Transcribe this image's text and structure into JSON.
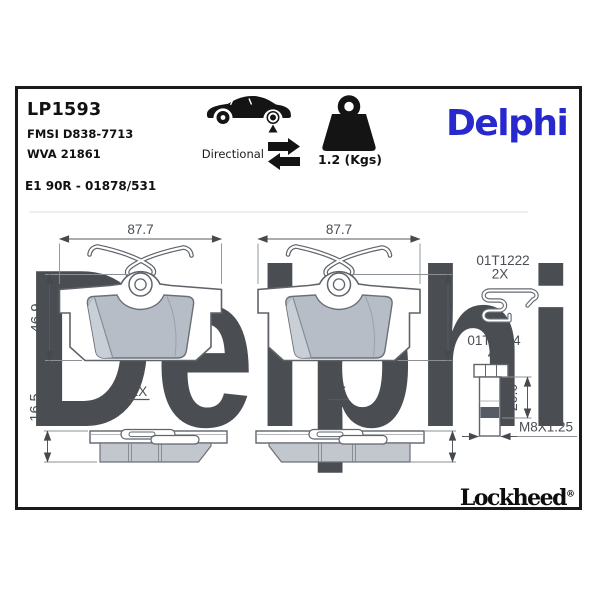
{
  "header": {
    "part_number": "LP1593",
    "fmsi_code": "FMSI D838-7713",
    "wva_code": "WVA 21861",
    "ece_approval": "E1 90R - 01878/531",
    "directional_label": "Directional",
    "weight_value": "1.2 (Kgs)"
  },
  "branding": {
    "logo_text": "Delphi",
    "watermark_text": "Delphi",
    "footer_logo_text": "Lockheed",
    "registered_symbol": "®"
  },
  "pad_set": {
    "width_mm": "87.7",
    "height_mm": "46.9",
    "thickness_mm": "16.5",
    "quantity_label": "2X"
  },
  "hardware": {
    "clip_part_number": "01T1222",
    "clip_quantity": "2X",
    "bolt_part_number": "01T0924",
    "bolt_quantity": "4X",
    "bolt_grip_length_mm": "20.0",
    "bolt_thread_spec": "M8X1.25"
  },
  "colors": {
    "brand_blue": "#2828cf",
    "watermark_blue": "#d2daea",
    "friction_gray": "#b7bdc6",
    "friction_light_gray": "#c9cfd6",
    "outline_gray": "#5f646b",
    "dimension_gray": "#55595e",
    "frame_black": "#1a1a1a"
  }
}
